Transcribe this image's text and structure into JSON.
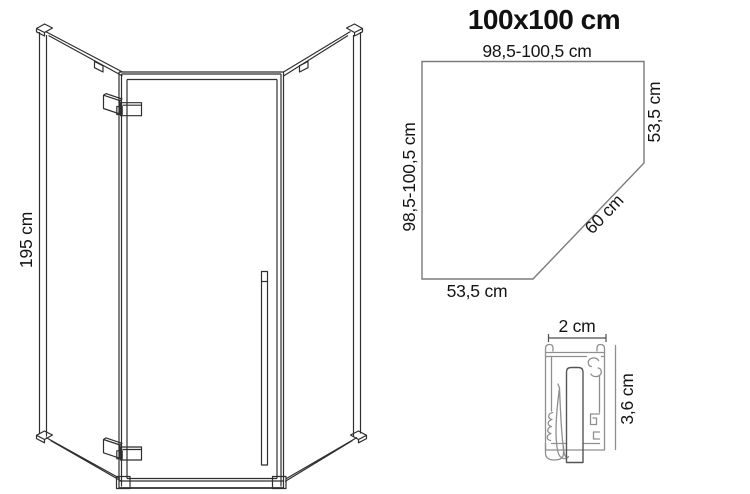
{
  "meta": {
    "background_color": "#ffffff",
    "drawing_line_color": "#2f2f2f",
    "outline_line_color": "#7b7b7b",
    "profile_line_color": "#8f8f8f",
    "text_color": "#141414"
  },
  "front_view": {
    "height_label": "195 cm"
  },
  "top_view": {
    "title": "100x100 cm",
    "top_edge_label": "98,5-100,5 cm",
    "left_edge_label": "98,5-100,5 cm",
    "right_edge_label": "53,5 cm",
    "bottom_edge_label": "53,5 cm",
    "diagonal_edge_label": "60 cm"
  },
  "profile_detail": {
    "width_label": "2 cm",
    "depth_label": "3,6 cm"
  }
}
